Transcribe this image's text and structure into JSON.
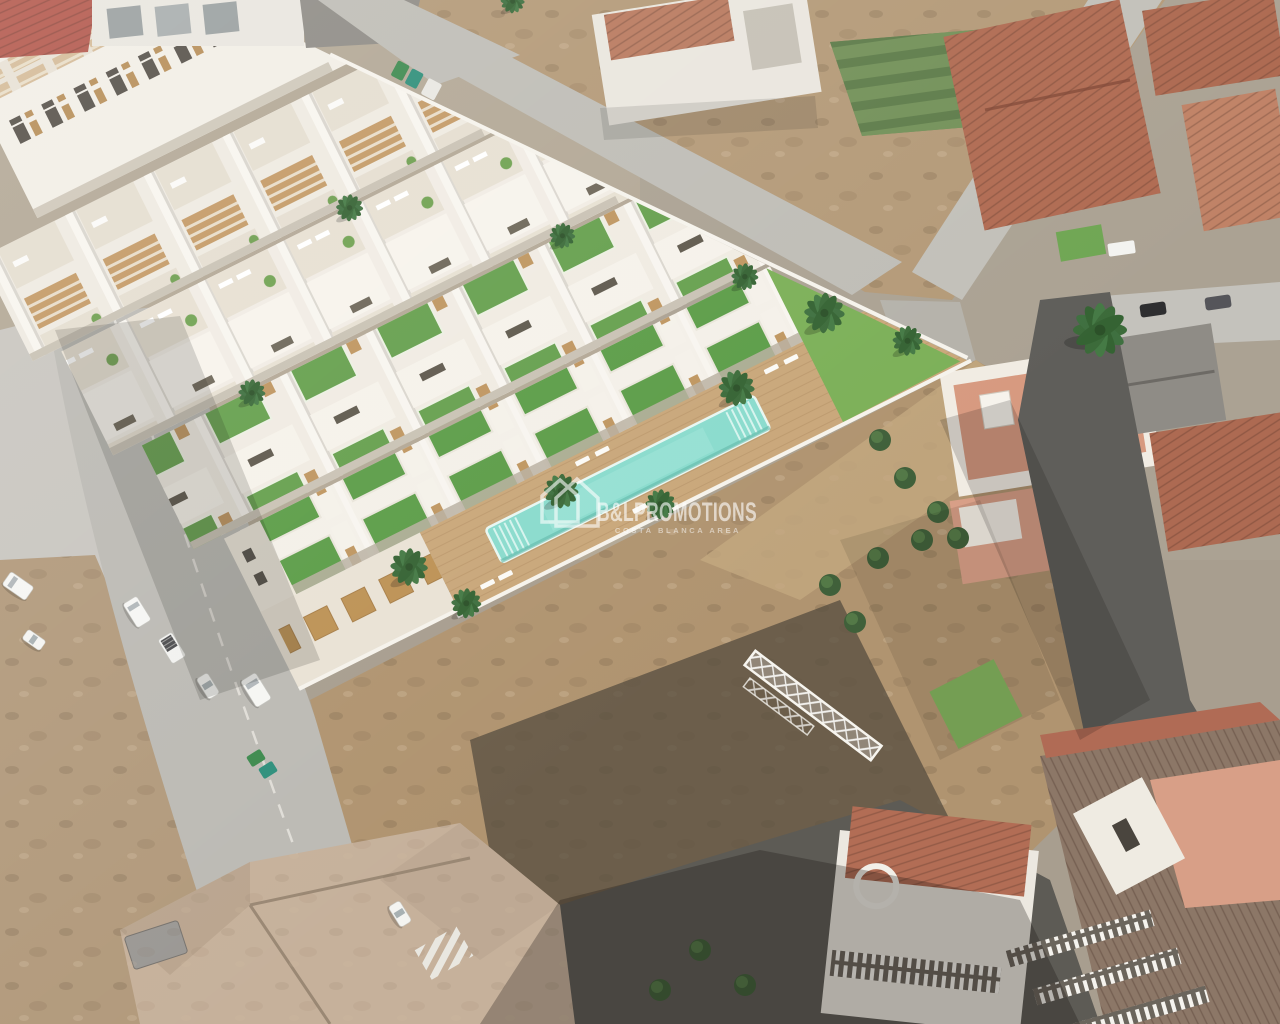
{
  "watermark": {
    "icon_name": "double-house-roof-icon",
    "brand": "B&LPROMOTIONS",
    "tagline": "COSTA BLANCA AREA"
  },
  "palette": {
    "white_building": "#f2eee6",
    "wood_pergola": "#c49a66",
    "roof_lawn_green": "#5c9d48",
    "communal_lawn": "#7cb058",
    "pool_water": "#8adbcd",
    "deck_wood": "#c9a77a",
    "dirt_light": "#b49a78",
    "dirt_burnt": "#564c3f",
    "road_light": "#bfbdb6",
    "road_dark": "#5d5b55",
    "terracotta_roof": "#b06b55",
    "salmon_terrace": "#d79a80",
    "tree_green": "#3f5d37",
    "watermark_white": "#ffffff"
  }
}
